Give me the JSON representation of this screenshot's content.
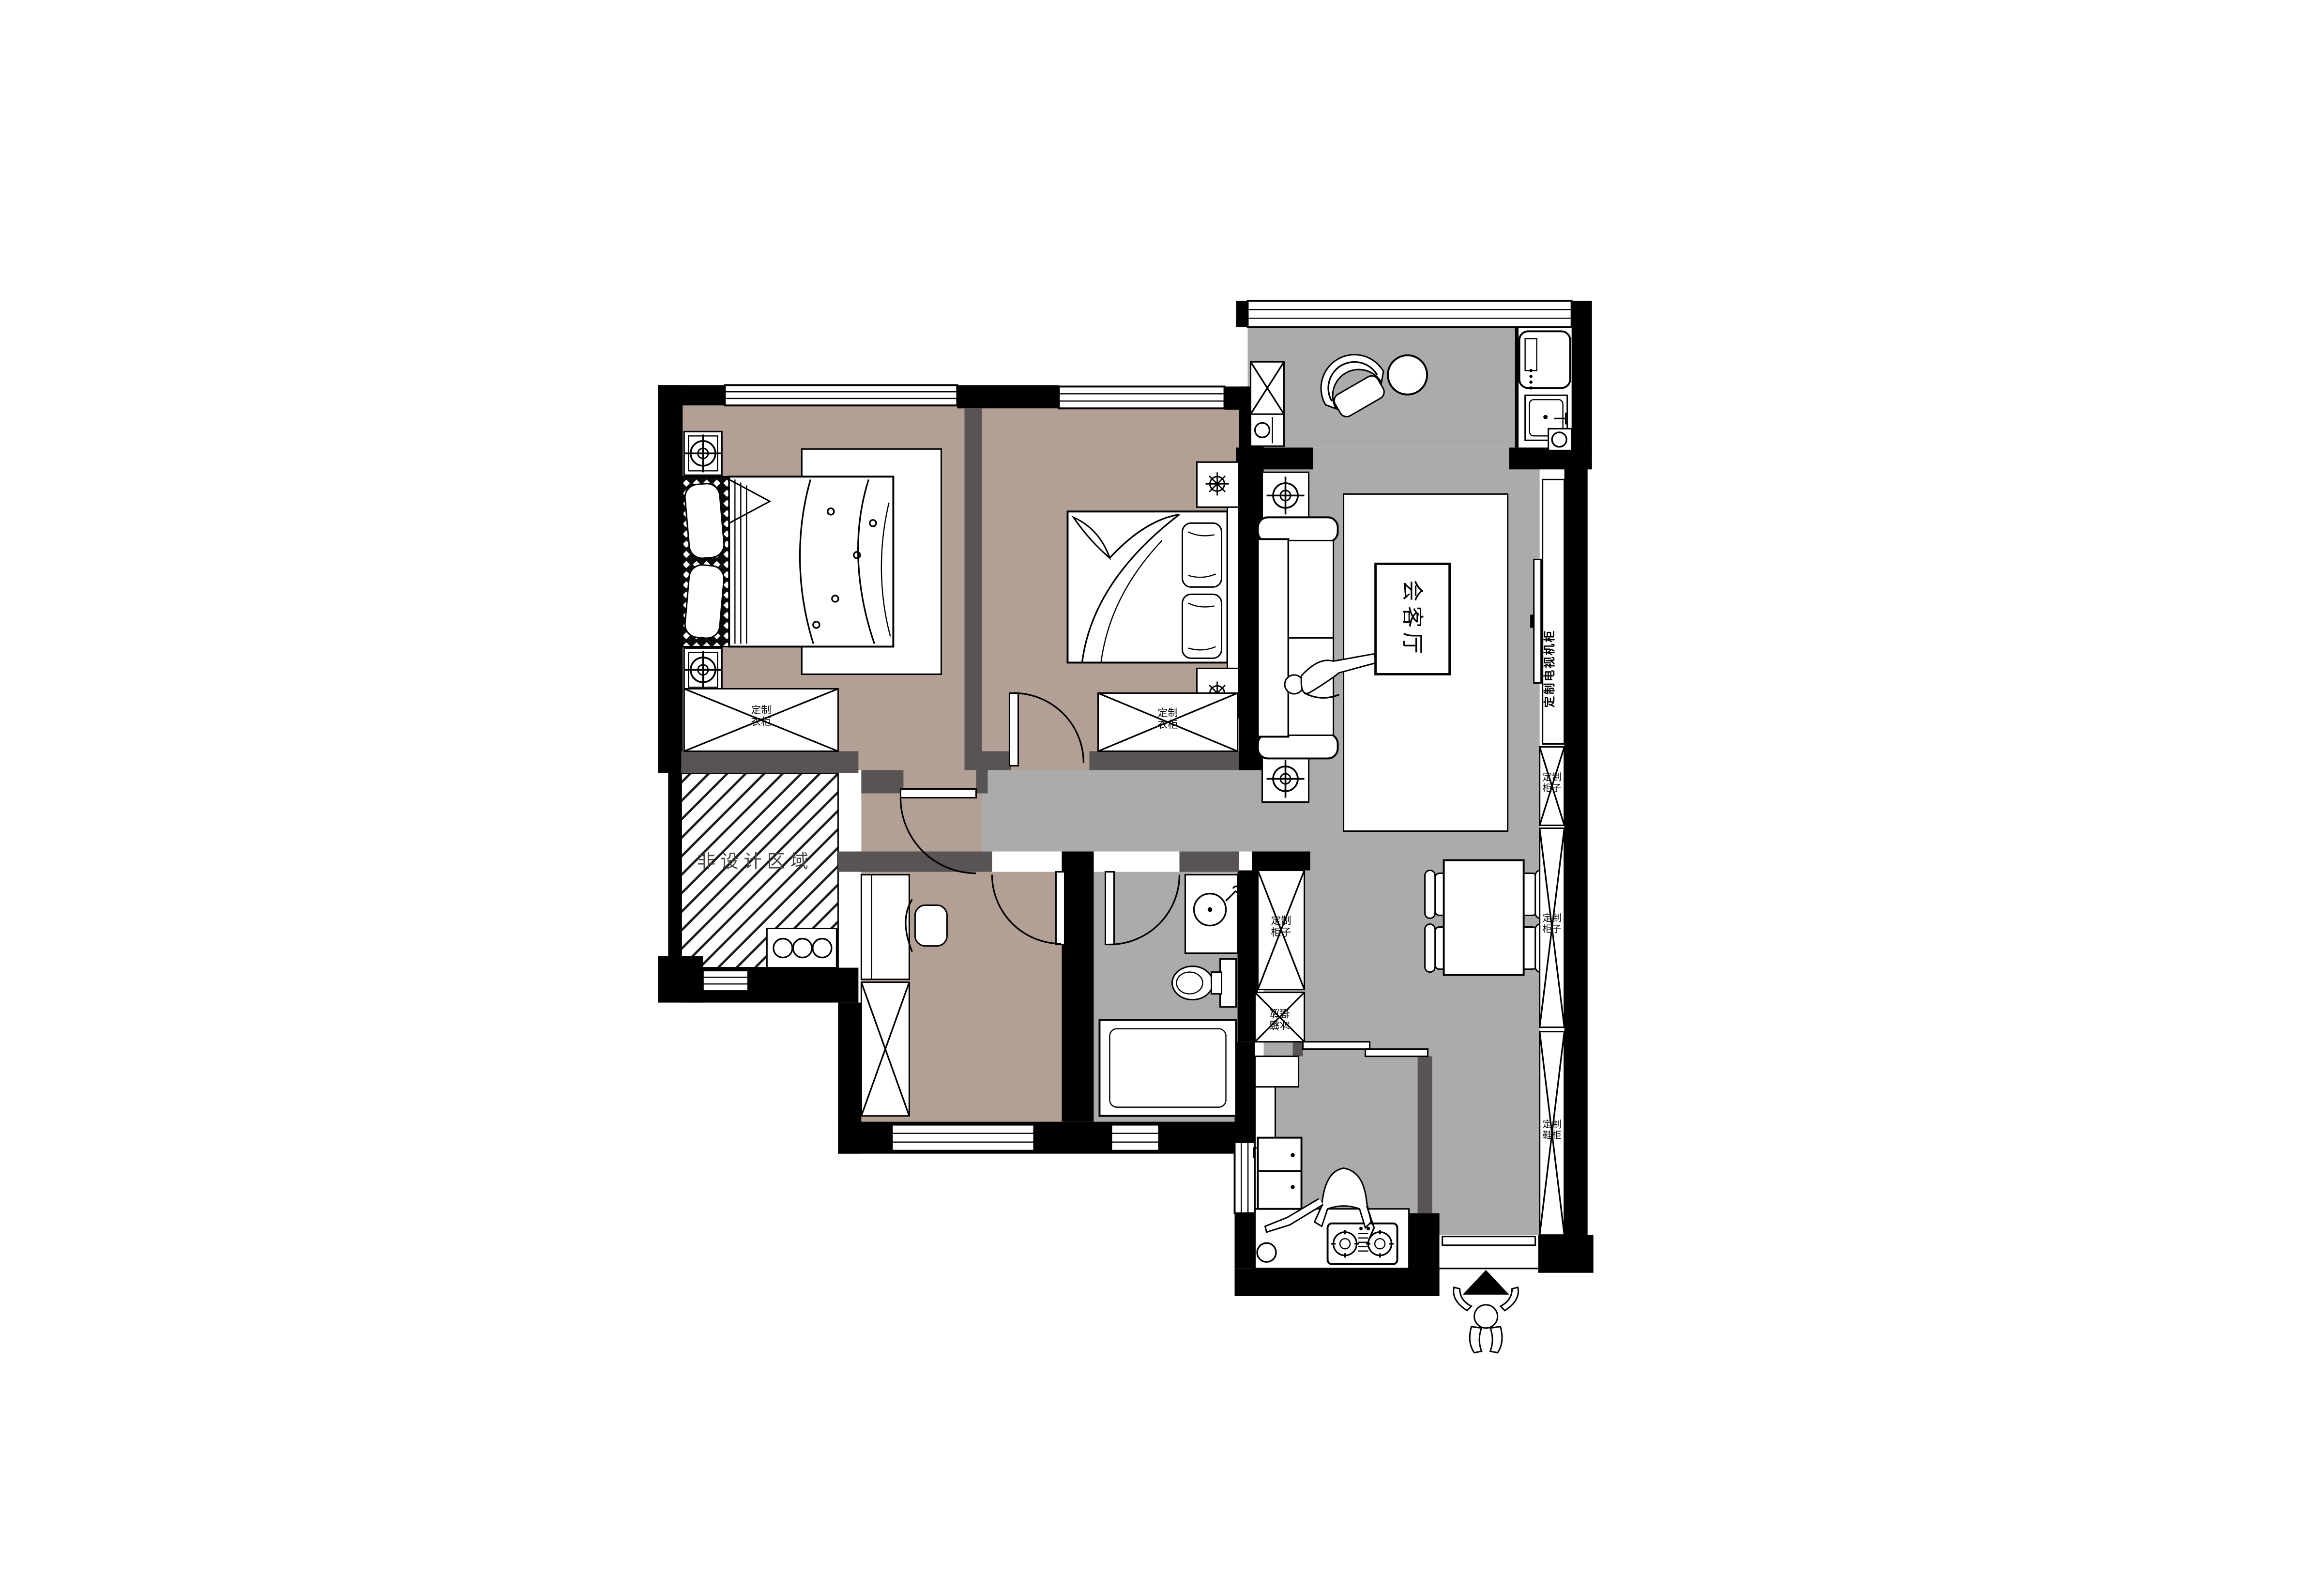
{
  "plan": {
    "type": "apartment-floor-plan",
    "labels": {
      "living_room": "会客厅",
      "non_design_area": "非设计区域",
      "master_wardrobe": "定制衣柜",
      "bedroom2_wardrobe": "定制衣柜",
      "tv_cabinet": "定制电视机柜",
      "dining_cabinet": "定制柜子",
      "fridge_space": "冰箱摆放",
      "hall_cabinet_upper": "定制柜子",
      "hall_cabinet_lower": "定制柜子",
      "shoe_cabinet": "定制鞋柜"
    },
    "colors": {
      "background": "#ffffff",
      "bedroom_floor": "#b1a093",
      "public_floor": "#ababab",
      "wall_primary": "#000000",
      "wall_secondary": "#595454",
      "line": "#000000"
    }
  }
}
